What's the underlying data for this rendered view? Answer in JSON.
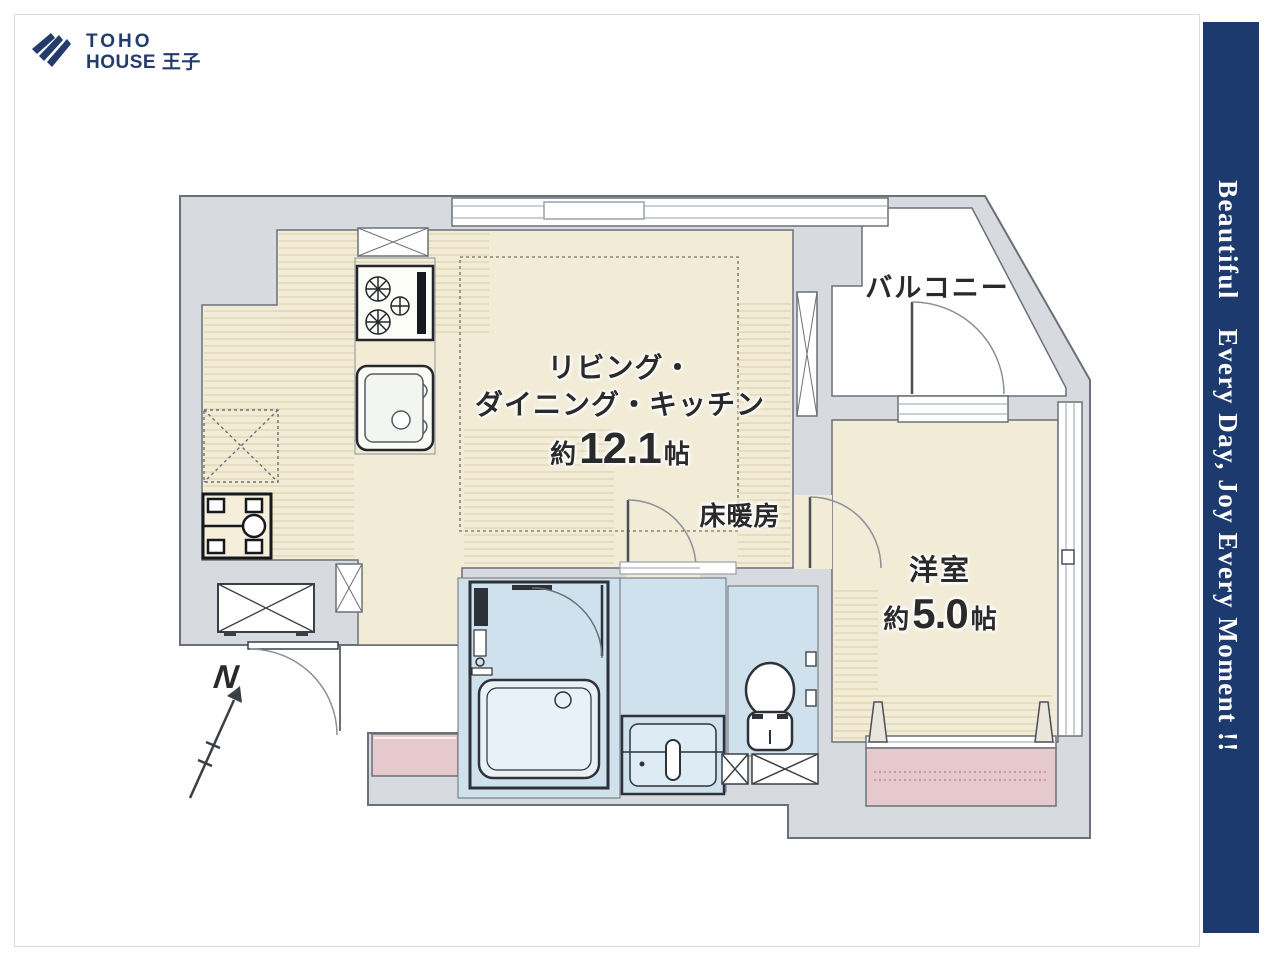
{
  "page": {
    "background": "#ffffff",
    "frame_color": "#dadada"
  },
  "logo": {
    "line1": "TOHO",
    "line2": "HOUSE 王子",
    "color": "#233c6b",
    "icon": "fan-pages-icon"
  },
  "side_banner": {
    "text": "Beautiful　Every Day, Joy Every Moment !!",
    "background": "#1d3a6e",
    "text_color": "#ffffff"
  },
  "plan": {
    "labels": {
      "ldk_line1": "リビング・",
      "ldk_line2": "ダイニング・キッチン",
      "ldk_size_prefix": "約",
      "ldk_size_value": "12.1",
      "ldk_size_unit": "帖",
      "floor_heating": "床暖房",
      "western_room": "洋室",
      "western_size_prefix": "約",
      "western_size_value": "5.0",
      "western_size_unit": "帖",
      "balcony": "バルコニー",
      "compass_north": "N"
    },
    "colors": {
      "floor": "#f2ebd6",
      "wall": "#d7dade",
      "outline": "#6b7078",
      "wet_area": "#cfe1ed",
      "fixture_outline": "#2e3238",
      "accent_pink": "#e6c9cd"
    }
  }
}
